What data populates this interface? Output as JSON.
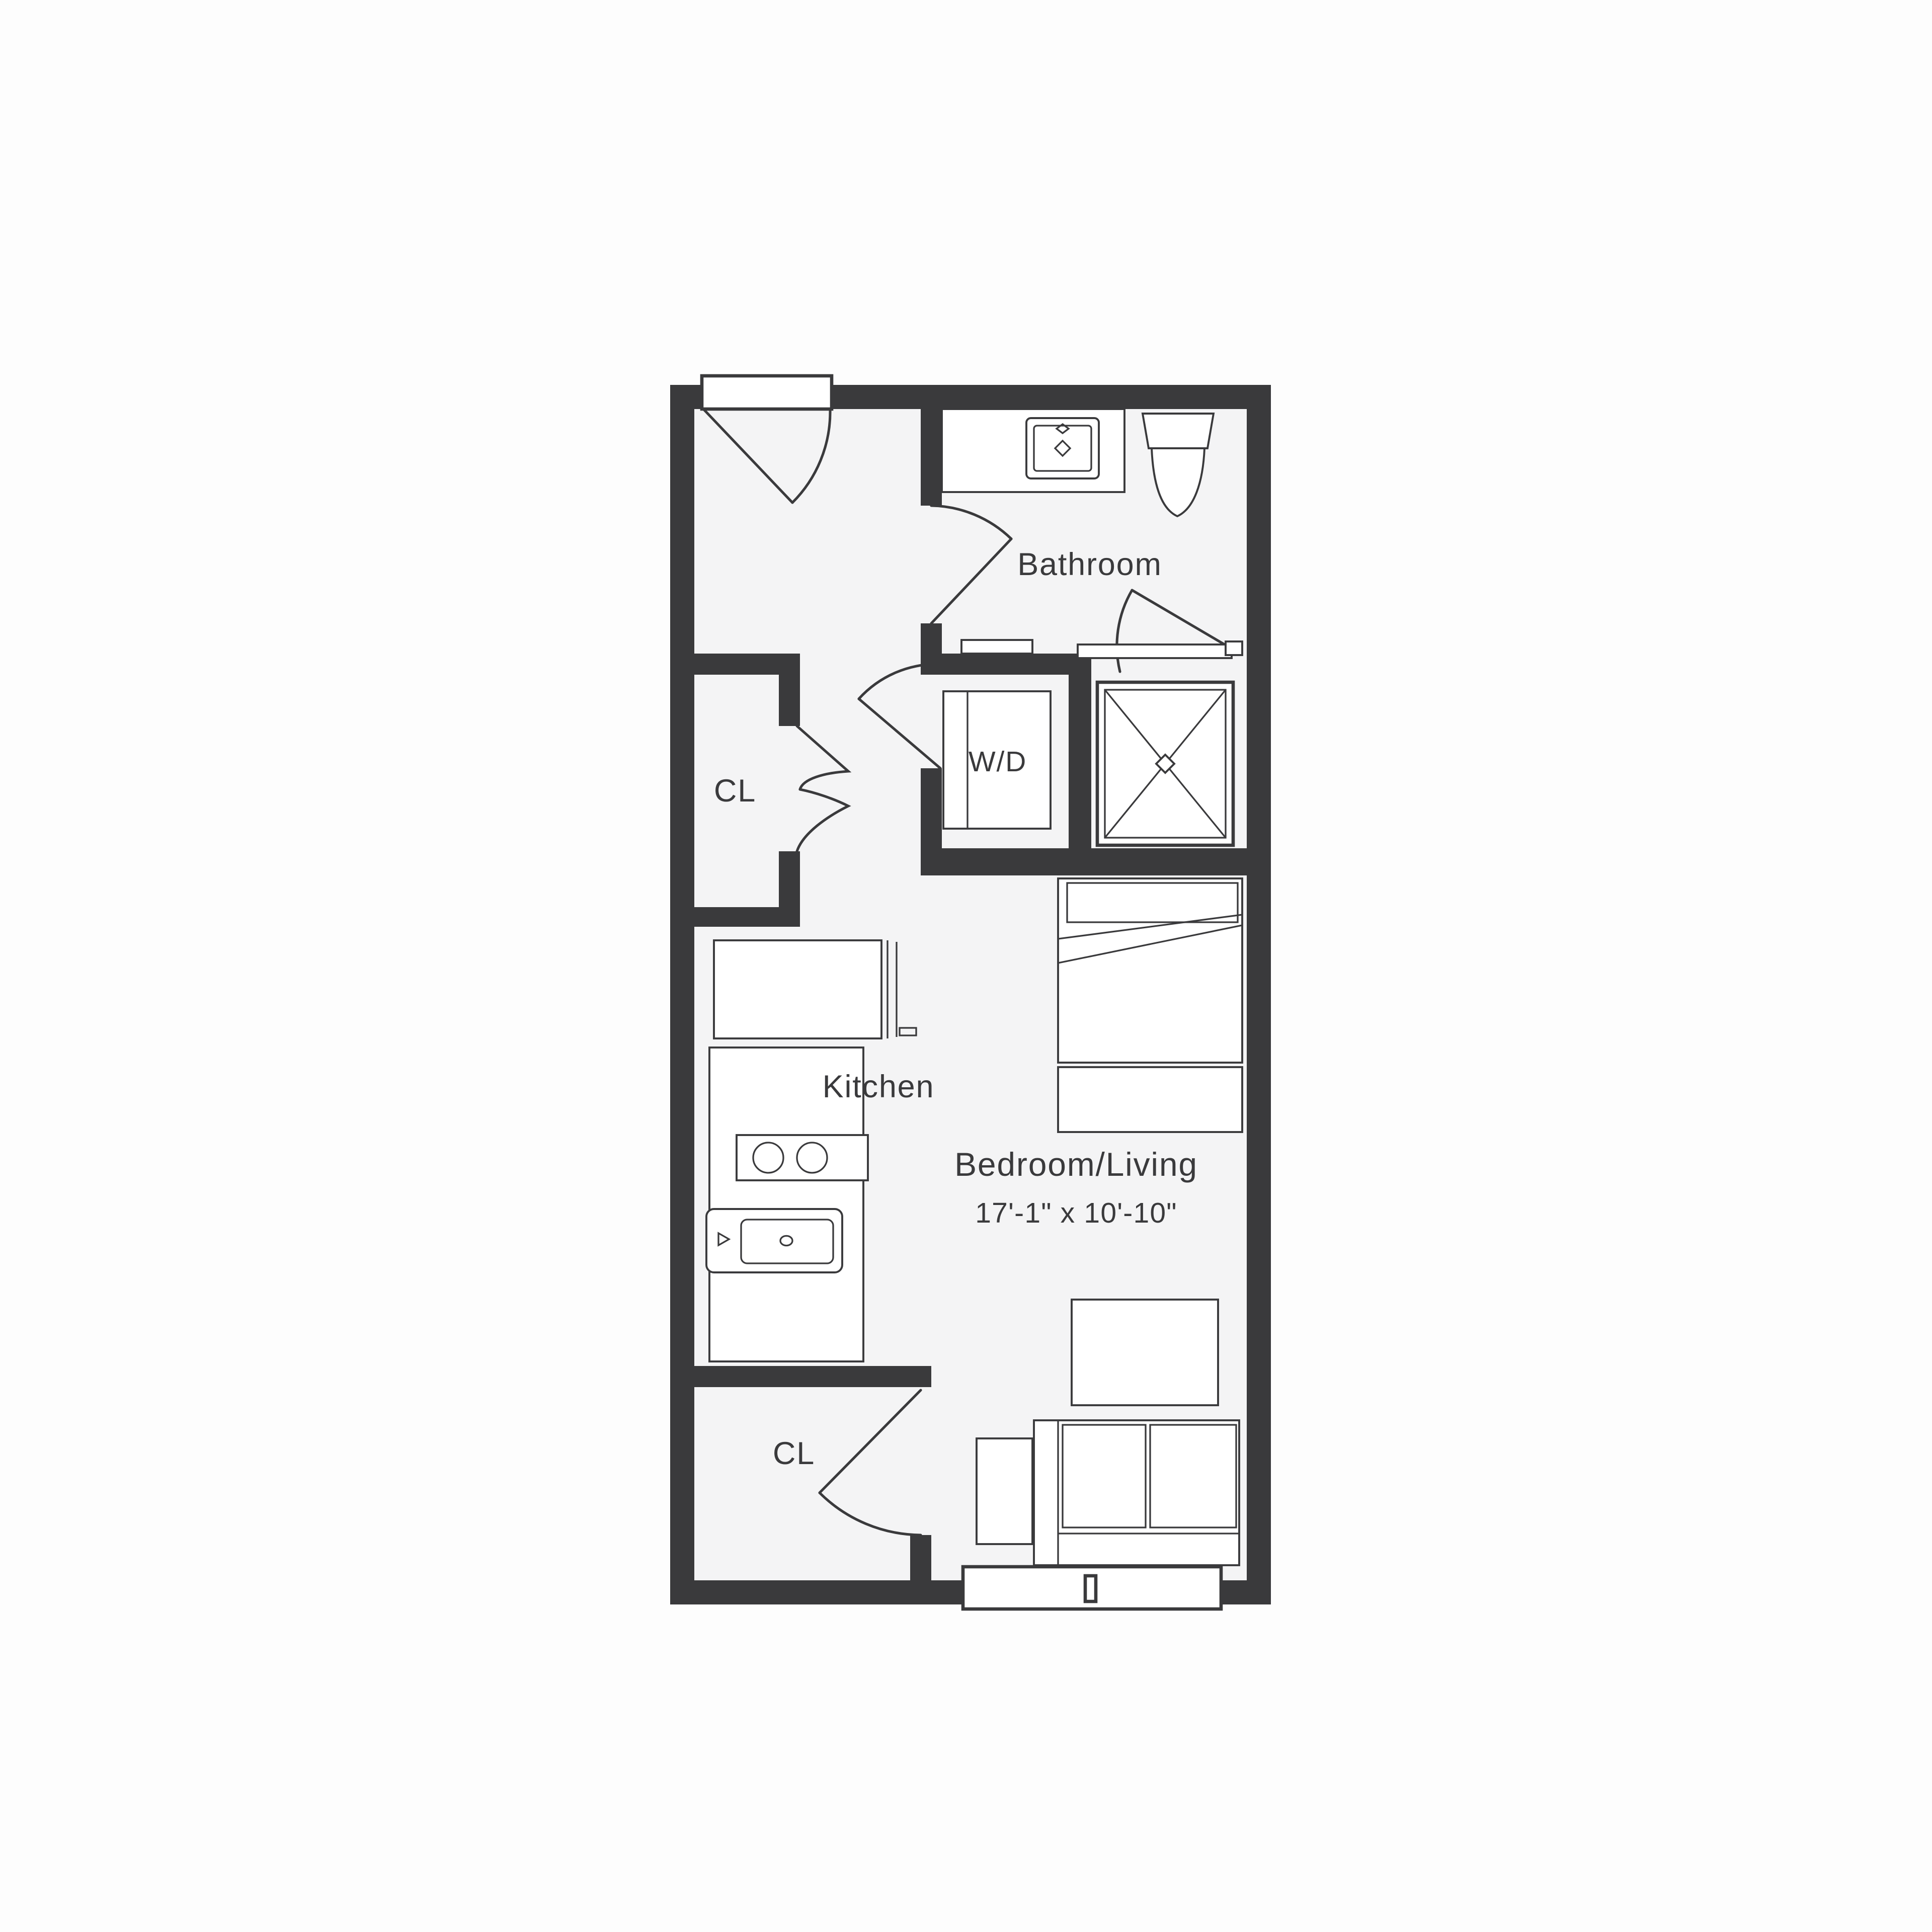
{
  "colors": {
    "wall": "#3A3A3C",
    "floor": "#F4F4F5",
    "background": "#FDFDFD",
    "line": "#3A3A3C",
    "fixture": "#FFFFFF",
    "text": "#3A3A3C"
  },
  "rooms": {
    "bathroom": {
      "label": "Bathroom"
    },
    "closet_hall": {
      "label": "CL"
    },
    "washer_dryer": {
      "label": "W/D"
    },
    "kitchen": {
      "label": "Kitchen"
    },
    "bedroom_living": {
      "label": "Bedroom/Living",
      "dimensions": "17'-1\" x 10'-10\""
    },
    "closet_entry": {
      "label": "CL"
    }
  }
}
